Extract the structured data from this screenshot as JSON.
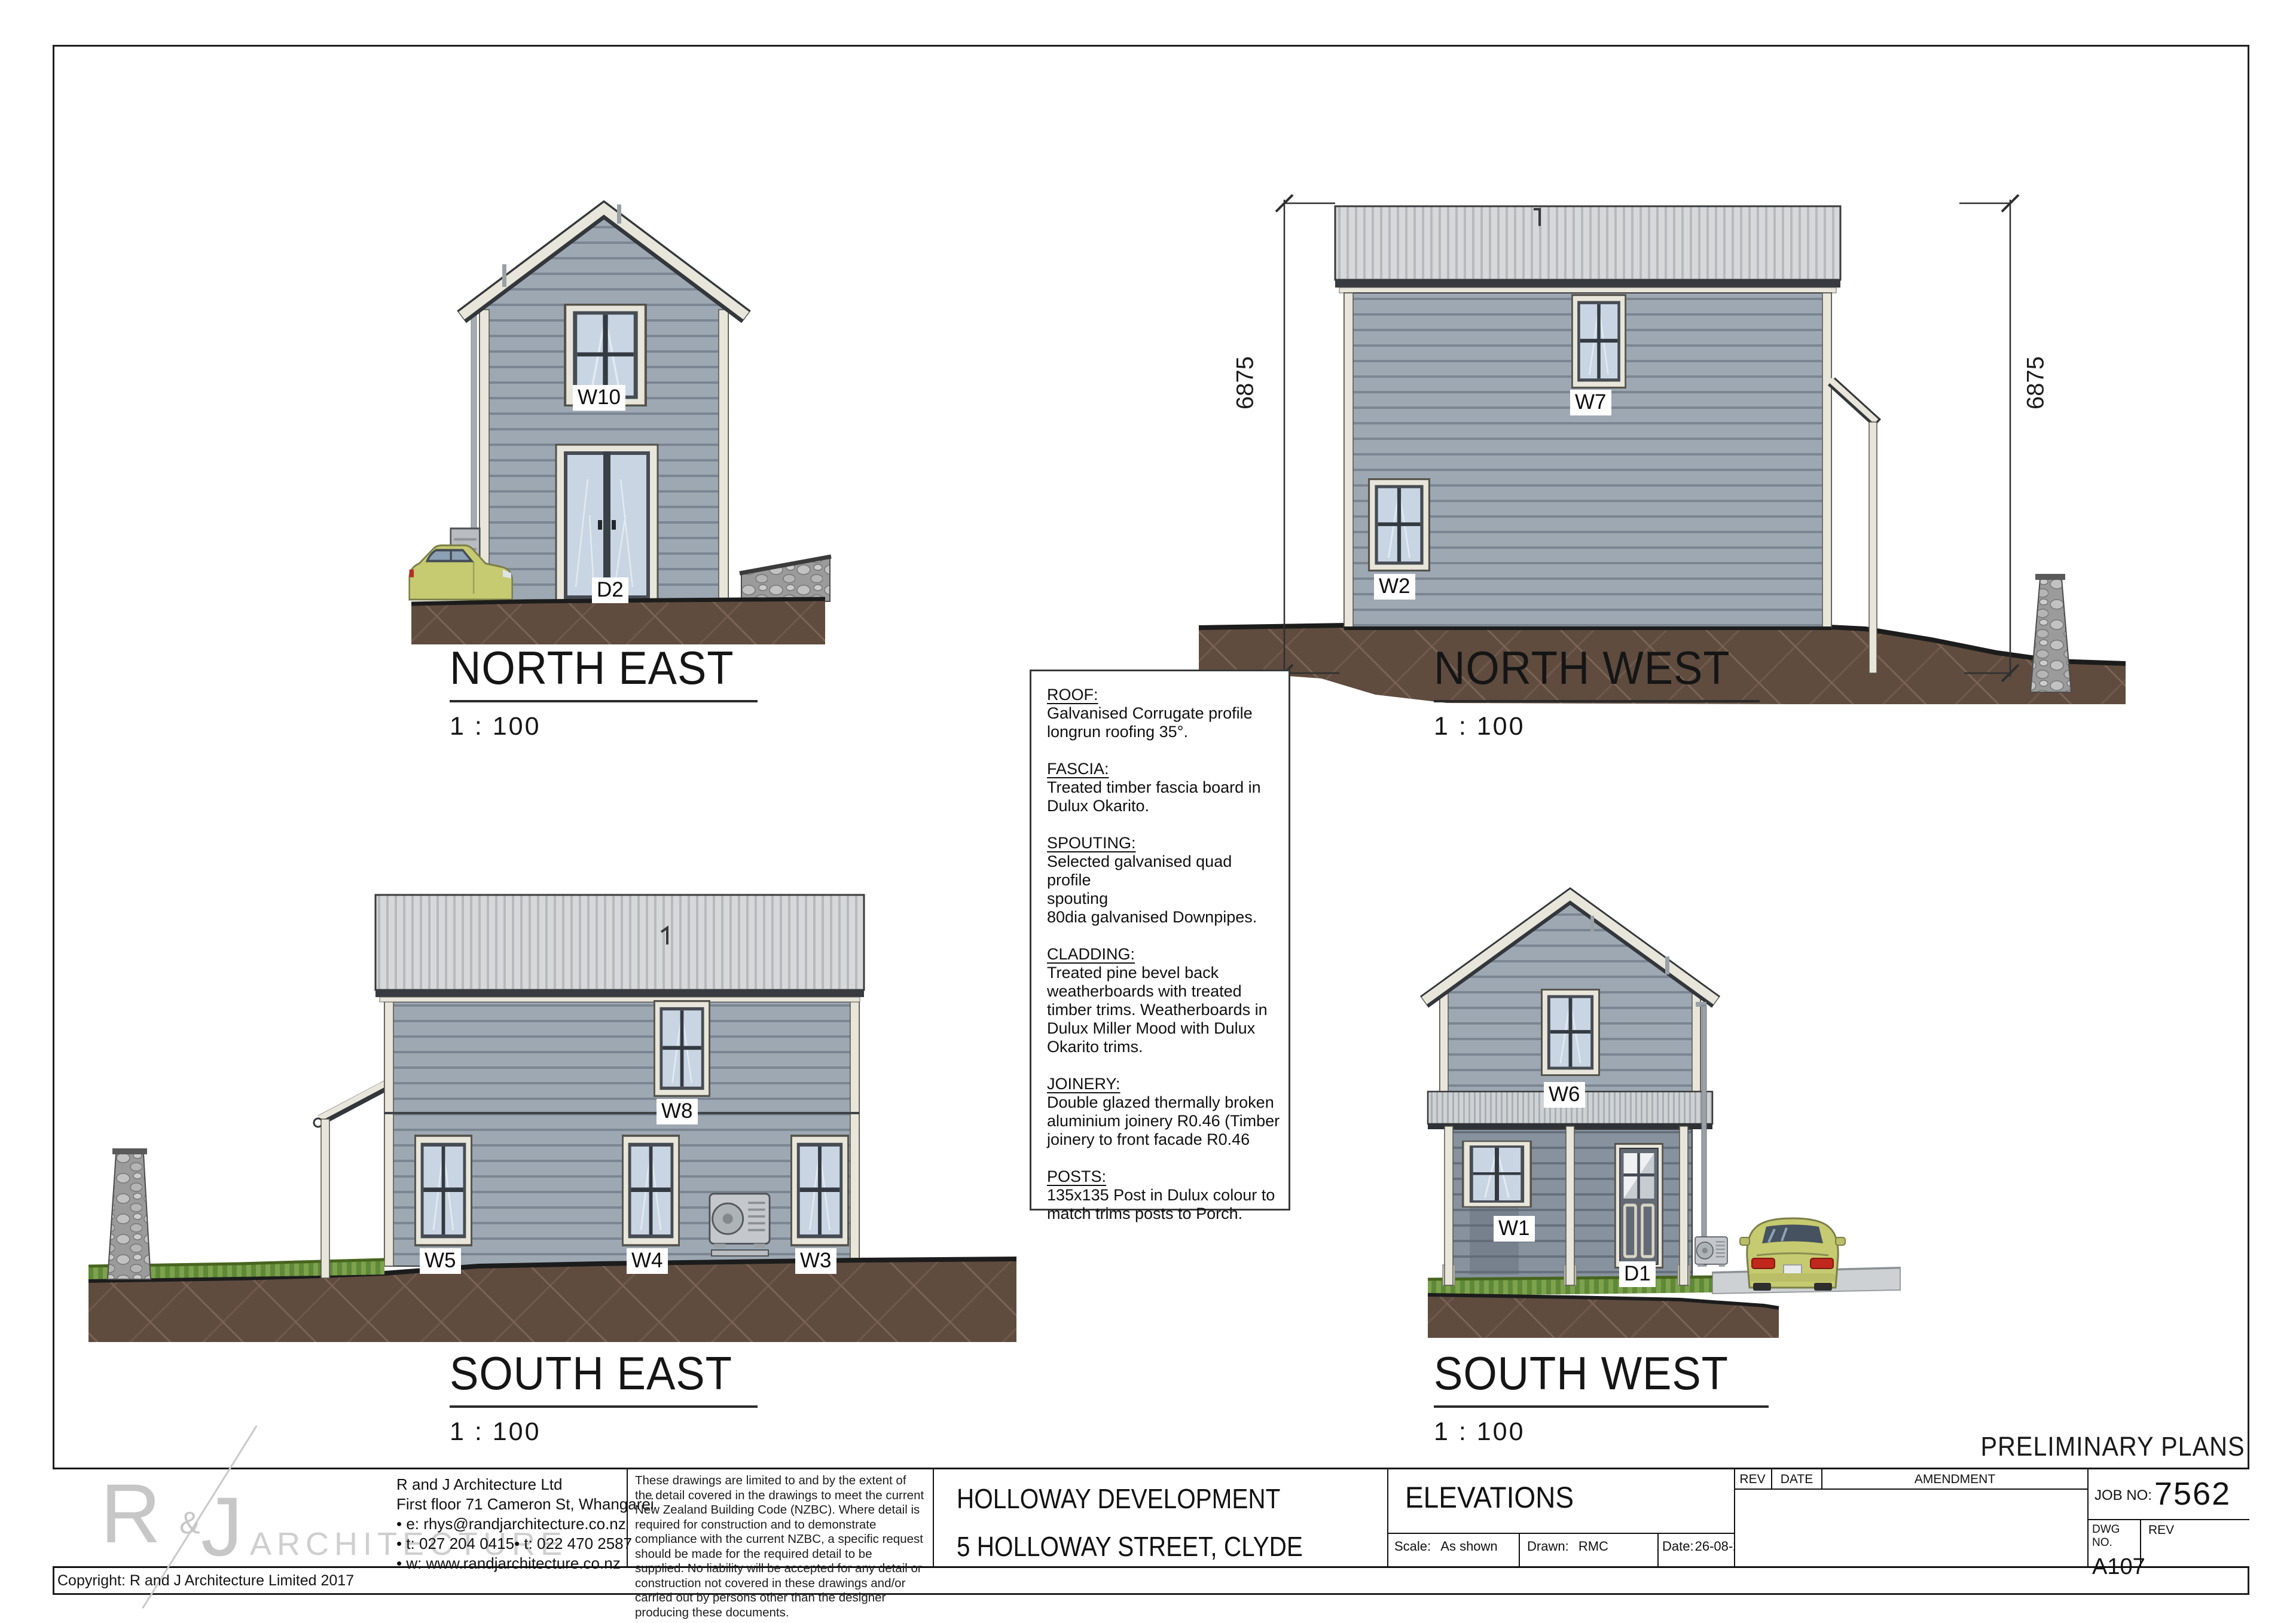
{
  "page": {
    "preliminary": "PRELIMINARY PLANS",
    "copyright": "Copyright: R and J Architecture Limited 2017"
  },
  "elevations": {
    "ne": {
      "title": "NORTH EAST",
      "scale": "1 : 100",
      "w10": "W10",
      "d2": "D2"
    },
    "nw": {
      "title": "NORTH WEST",
      "scale": "1 : 100",
      "w7": "W7",
      "w2": "W2",
      "dim_left": "6875",
      "dim_right": "6875"
    },
    "se": {
      "title": "SOUTH EAST",
      "scale": "1 : 100",
      "w8": "W8",
      "w5": "W5",
      "w4": "W4",
      "w3": "W3"
    },
    "sw": {
      "title": "SOUTH WEST",
      "scale": "1 : 100",
      "w6": "W6",
      "w1": "W1",
      "d1": "D1"
    }
  },
  "specs": {
    "sections": [
      {
        "heading": "ROOF:",
        "body": "Galvanised Corrugate profile\nlongrun roofing 35°."
      },
      {
        "heading": "FASCIA:",
        "body": "Treated timber fascia board in\nDulux Okarito."
      },
      {
        "heading": "SPOUTING:",
        "body": "Selected galvanised quad profile\nspouting\n80dia galvanised Downpipes."
      },
      {
        "heading": "CLADDING:",
        "body": "Treated pine bevel back\nweatherboards with treated\ntimber trims. Weatherboards in\nDulux Miller Mood with Dulux\nOkarito trims."
      },
      {
        "heading": "JOINERY:",
        "body": "Double glazed thermally broken\naluminium joinery R0.46 (Timber\njoinery to front facade R0.46"
      },
      {
        "heading": "POSTS:",
        "body": "135x135 Post in Dulux colour to\nmatch trims posts to Porch."
      }
    ]
  },
  "titleblock": {
    "logo": {
      "r": "R",
      "amp": "&",
      "j": "J",
      "word": "ARCHITECTURE"
    },
    "company": {
      "lines": [
        "R and J Architecture Ltd",
        "First floor 71 Cameron St, Whangarei",
        "• e: rhys@randjarchitecture.co.nz",
        "• t: 027 204 0415• t: 022 470 2587",
        "• w: www.randjarchitecture.co.nz"
      ]
    },
    "disclaimer": "These drawings are limited to and by the extent of the detail covered in the drawings to meet the current New Zealand Building Code (NZBC). Where detail is required for construction and to demonstrate compliance with the current NZBC, a specific request should be made for the required detail to be supplied. No liability will be accepted for any detail or construction not covered in these drawings and/or carried out by persons other than the designer producing these documents.",
    "project": {
      "name": "HOLLOWAY DEVELOPMENT",
      "address": "5 HOLLOWAY STREET, CLYDE"
    },
    "drawing": {
      "title": "ELEVATIONS",
      "scale_label": "Scale:",
      "scale_value": "As shown",
      "drawn_label": "Drawn:",
      "drawn_value": "RMC",
      "date_label": "Date:",
      "date_value": "26-08-25"
    },
    "rev_table": {
      "rev": "REV",
      "date": "DATE",
      "amendment": "AMENDMENT"
    },
    "job": {
      "label": "JOB NO:",
      "value": "7562"
    },
    "dwg": {
      "label": "DWG NO.",
      "value": "A107",
      "rev_label": "REV"
    }
  },
  "colors": {
    "cladding": "#9da8b3",
    "cladding_shade": "#87929e",
    "trim": "#e8e6da",
    "roof": "#d5d7d9",
    "glass": "#c9d5e3",
    "ground": "#5f4c3f",
    "grass": "#7ca24c",
    "stone": "#a5a5a5",
    "car": "#c6ca70"
  }
}
